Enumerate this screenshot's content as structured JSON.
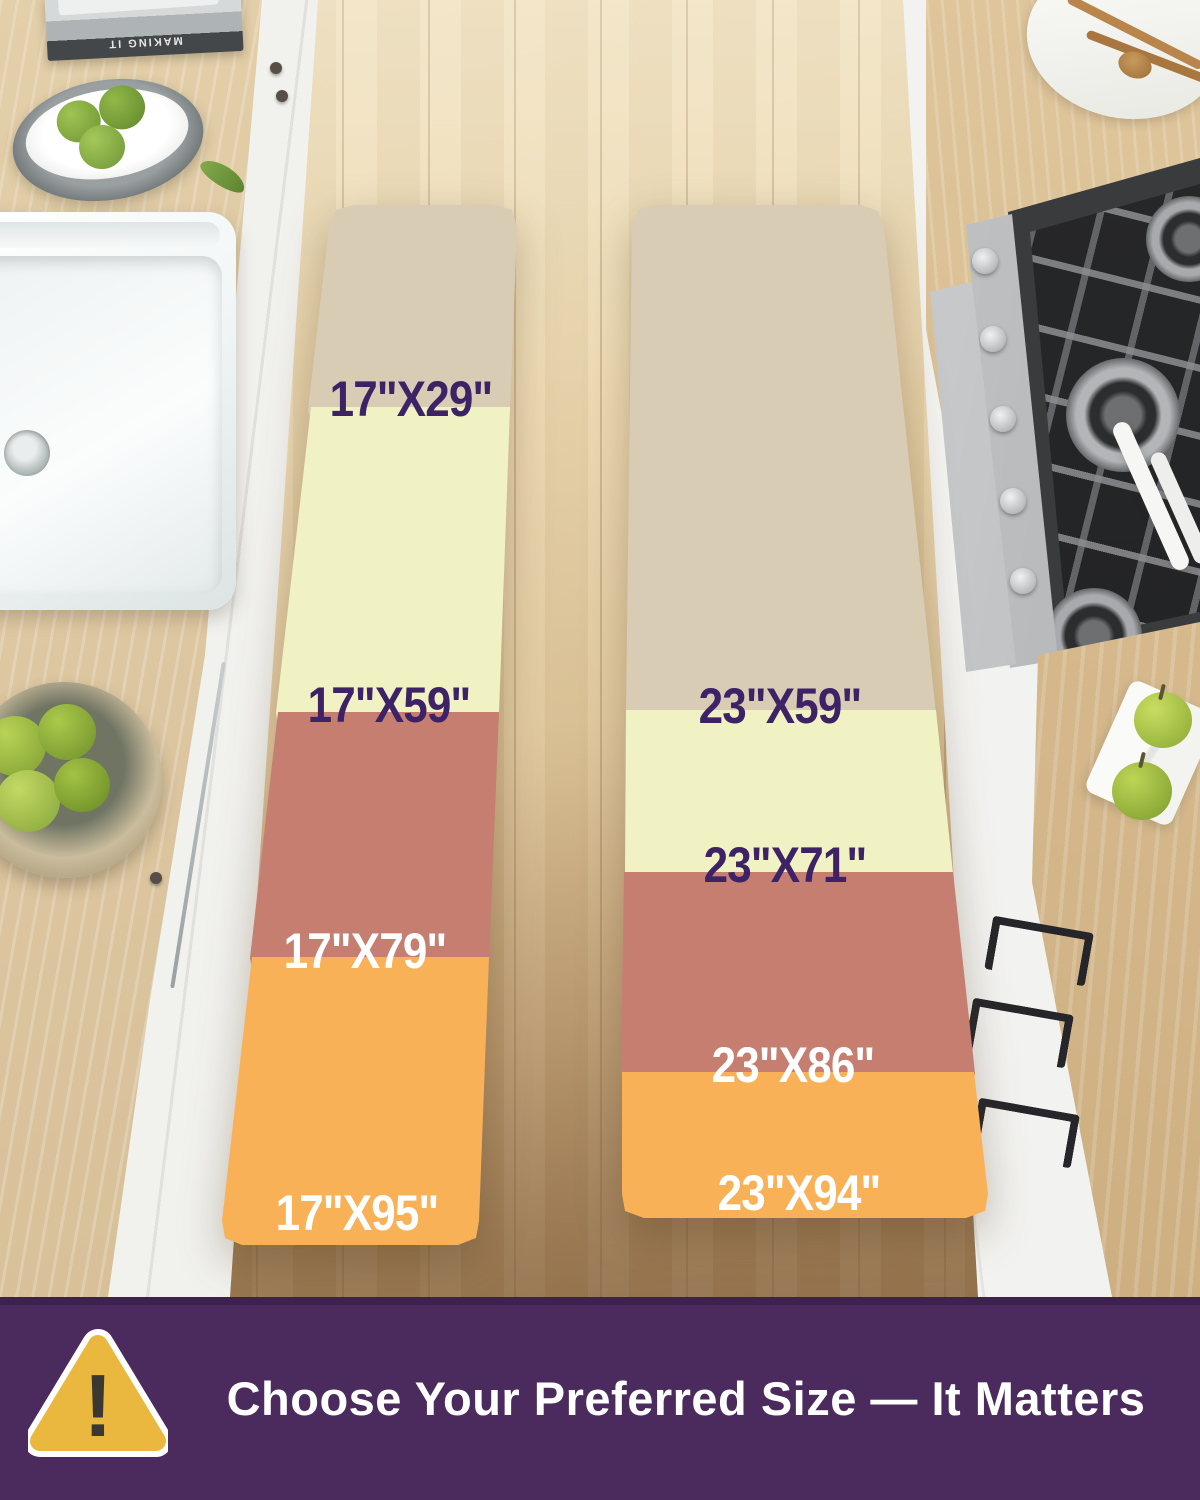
{
  "mats": {
    "left": {
      "name": "17-inch wide runner size stack",
      "segments": [
        {
          "label": "17\"X29\"",
          "color": "#d9ccb4",
          "text_color": "#3d2366"
        },
        {
          "label": "17\"X59\"",
          "color": "#f0f2c3",
          "text_color": "#3d2366"
        },
        {
          "label": "17\"X79\"",
          "color": "#c67e70",
          "text_color": "#ffffff"
        },
        {
          "label": "17\"X95\"",
          "color": "#f9b157",
          "text_color": "#ffffff"
        }
      ]
    },
    "right": {
      "name": "23-inch wide runner size stack",
      "segments": [
        {
          "label": "23\"X59\"",
          "color": "#d9ccb4",
          "text_color": "#3d2366"
        },
        {
          "label": "23\"X71\"",
          "color": "#f0f2c3",
          "text_color": "#3d2366"
        },
        {
          "label": "23\"X86\"",
          "color": "#c67e70",
          "text_color": "#ffffff"
        },
        {
          "label": "23\"X94\"",
          "color": "#f9b157",
          "text_color": "#ffffff"
        }
      ]
    }
  },
  "banner": {
    "text": "Choose Your Preferred Size — It Matters",
    "bg_color": "#4b2a5e",
    "icon": "warning-triangle-icon",
    "icon_color": "#eab83f",
    "exclamation": "!"
  },
  "decor": {
    "book_spine_text": "MAKING IT"
  }
}
